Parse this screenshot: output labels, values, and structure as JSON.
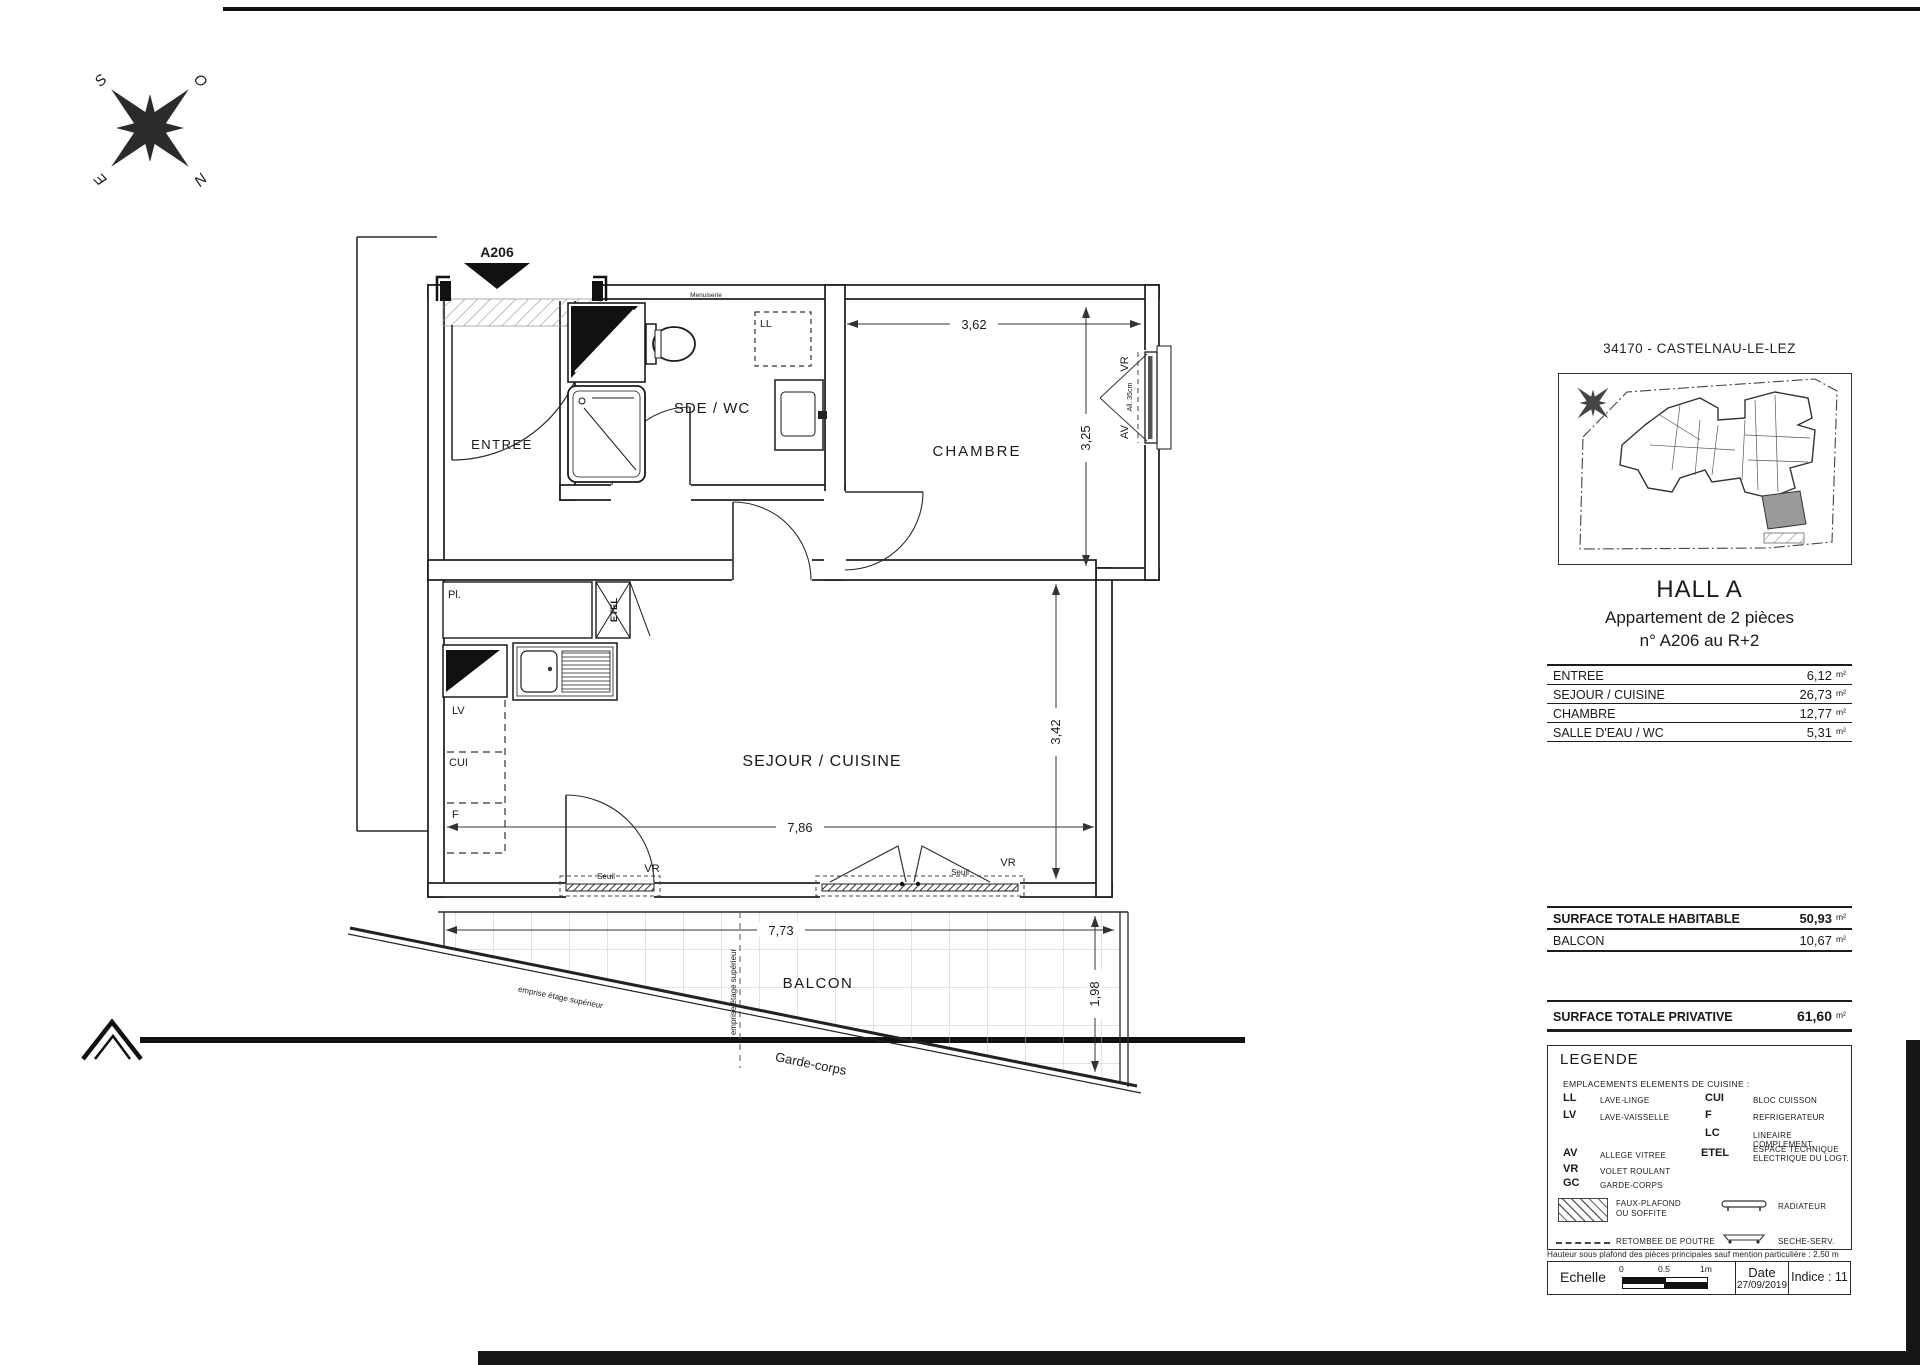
{
  "plan": {
    "entry_label": "A206",
    "rooms": {
      "entree": "ENTREE",
      "sde": "SDE / WC",
      "chambre": "CHAMBRE",
      "sejour": "SEJOUR / CUISINE",
      "balcon": "BALCON"
    },
    "dims": {
      "chambre_w": "3,62",
      "chambre_h": "3,25",
      "sejour_h": "3,42",
      "sejour_w": "7,86",
      "balcon_w": "7,73",
      "balcon_d": "1,98"
    },
    "fixtures": {
      "ll": "LL",
      "lv": "LV",
      "cui": "CUI",
      "f": "F",
      "etel": "ETEL",
      "placard": "Pl."
    },
    "window": {
      "vr": "VR",
      "av": "AV",
      "allege": "All. 35cm"
    },
    "doors": {
      "seuil": "Seuil",
      "vr": "VR"
    },
    "balcony": {
      "garde_corps": "Garde-corps",
      "emprise": "emprise étage supérieur"
    },
    "wall_note": "Menuiserie",
    "compass": {
      "n": "N",
      "s": "S",
      "e": "E",
      "o": "O"
    }
  },
  "panel": {
    "city": "34170 - CASTELNAU-LE-LEZ",
    "hall": "HALL A",
    "apt_type": "Appartement de 2 pièces",
    "apt_num": "n° A206 au R+2",
    "unit": "m²",
    "rooms": [
      {
        "label": "ENTREE",
        "area": "6,12"
      },
      {
        "label": "SEJOUR / CUISINE",
        "area": "26,73"
      },
      {
        "label": "CHAMBRE",
        "area": "12,77"
      },
      {
        "label": "SALLE D'EAU / WC",
        "area": "5,31"
      }
    ],
    "habitable_label": "SURFACE TOTALE HABITABLE",
    "habitable_area": "50,93",
    "balcon_label": "BALCON",
    "balcon_area": "10,67",
    "privative_label": "SURFACE TOTALE PRIVATIVE",
    "privative_area": "61,60",
    "legend": {
      "title": "LEGENDE",
      "subtitle": "EMPLACEMENTS ELEMENTS DE CUISINE :",
      "items_left": [
        {
          "abbr": "LL",
          "def": "LAVE-LINGE"
        },
        {
          "abbr": "LV",
          "def": "LAVE-VAISSELLE"
        },
        {
          "abbr": "AV",
          "def": "ALLEGE VITREE"
        },
        {
          "abbr": "VR",
          "def": "VOLET ROULANT"
        },
        {
          "abbr": "GC",
          "def": "GARDE-CORPS"
        }
      ],
      "items_right": [
        {
          "abbr": "CUI",
          "def": "BLOC CUISSON"
        },
        {
          "abbr": "F",
          "def": "REFRIGERATEUR"
        },
        {
          "abbr": "LC",
          "def": "LINEAIRE COMPLEMENT."
        },
        {
          "abbr": "ETEL",
          "def": "ESPACE TECHNIQUE",
          "def2": "ELECTRIQUE DU LOGT."
        }
      ],
      "faux_plafond1": "FAUX-PLAFOND",
      "faux_plafond2": "OU SOFFITE",
      "retombee": "RETOMBEE DE POUTRE",
      "radiateur": "RADIATEUR",
      "seche": "SECHE-SERV."
    },
    "note": "Hauteur sous plafond des pièces principales sauf mention particulière : 2,50 m",
    "scale": {
      "label": "Echelle",
      "t0": "0",
      "t05": "0.5",
      "t1": "1m"
    },
    "date_label": "Date",
    "date_value": "27/09/2019",
    "indice": "Indice : 11"
  }
}
